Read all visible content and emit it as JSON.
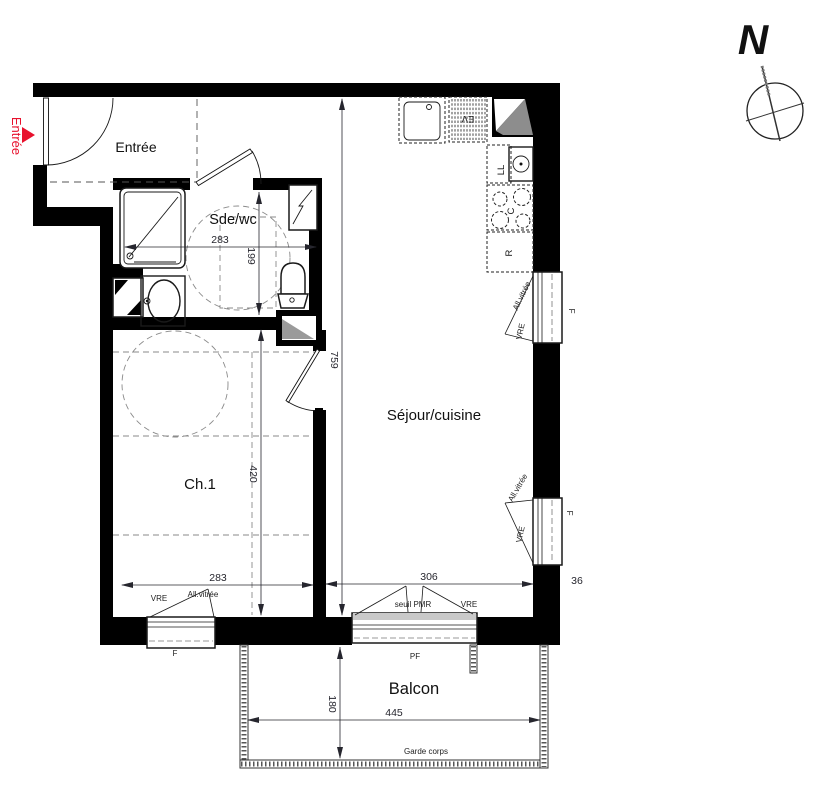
{
  "colors": {
    "wall": "#000000",
    "accent_red": "#e8112d",
    "dim_text": "#26262e"
  },
  "rooms": {
    "entree": "Entrée",
    "sdewc": "Sde/wc",
    "ch1": "Ch.1",
    "sejour": "Séjour/cuisine",
    "balcon": "Balcon"
  },
  "entry": {
    "label": "Entrée"
  },
  "compass": {
    "north": "N"
  },
  "dims": {
    "sdewc_width": "283",
    "sdewc_depth": "199",
    "sejour_depth": "759",
    "ch1_depth": "420",
    "ch1_width": "283",
    "sejour_width": "306",
    "wall_return": "36",
    "balcon_width": "445",
    "balcon_depth": "180"
  },
  "openings": {
    "vre": "VRE",
    "all_vitree": "All.vitrée",
    "f": "F",
    "pf": "PF",
    "seuil_pmr": "seuil PMR",
    "garde_corps": "Garde corps"
  },
  "appliances": {
    "sink": "EV",
    "washer": "LL",
    "cooktop": "C",
    "fridge": "R"
  }
}
